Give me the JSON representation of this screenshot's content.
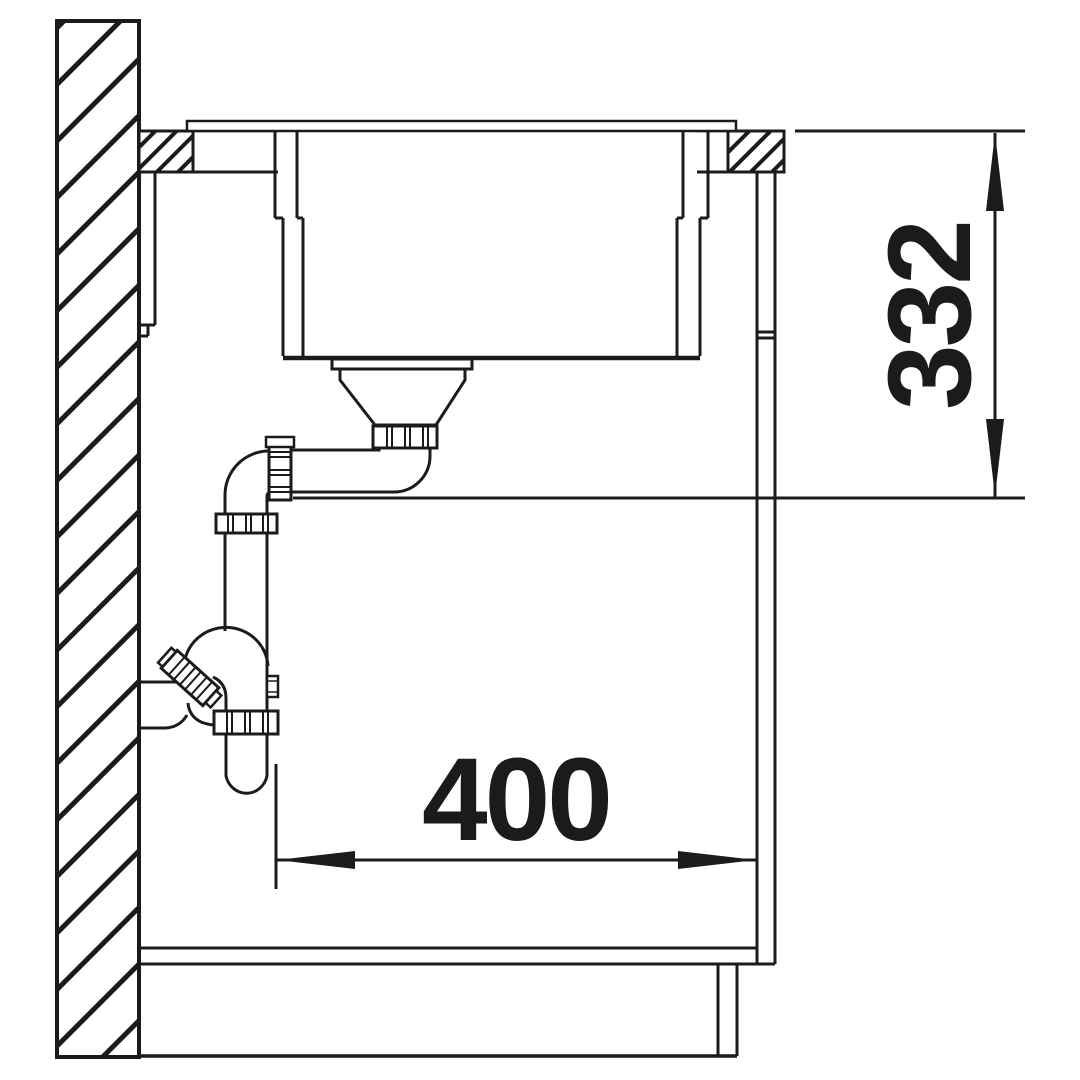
{
  "drawing": {
    "type": "sink-installation-cross-section",
    "dimensions": {
      "height_mm": "332",
      "depth_mm": "400"
    },
    "colors": {
      "line": "#1b1b1b",
      "background": "#ffffff"
    }
  }
}
